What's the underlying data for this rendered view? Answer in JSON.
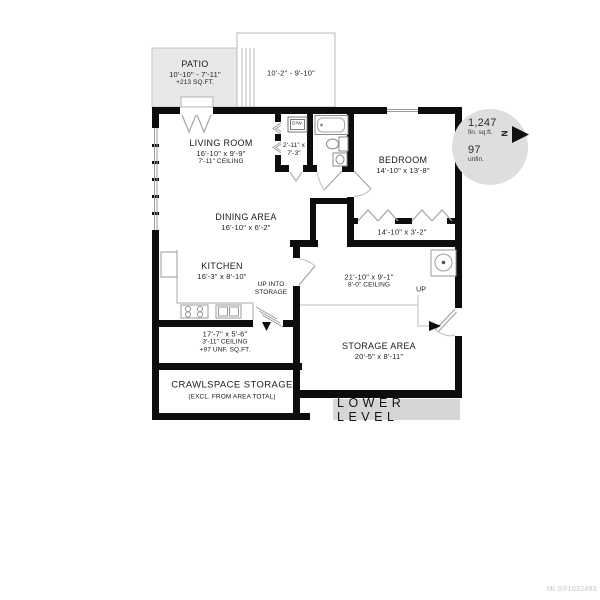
{
  "plan": {
    "patio": {
      "name": "PATIO",
      "dims": "10'-10\" - 7'-11\"",
      "area": "+213 SQ.FT."
    },
    "deck": {
      "dims": "10'-2\" - 9'-10\""
    },
    "living_room": {
      "name": "LIVING ROOM",
      "dims": "16'-10\" x 9'-9\"",
      "ceiling": "7'-11\" CEILING"
    },
    "laundry_closet": {
      "dims_line1": "2'-11\" x",
      "dims_line2": "7'-3\"",
      "appliance_label": "D/W"
    },
    "bedroom": {
      "name": "BEDROOM",
      "dims": "14'-10\" x 13'-8\""
    },
    "bedroom_closet": {
      "dims": "14'-10\" x 3'-2\""
    },
    "dining_area": {
      "name": "DINING AREA",
      "dims": "16'-10\" x 6'-2\""
    },
    "kitchen": {
      "name": "KITCHEN",
      "dims": "16'-3\" x 8'-10\""
    },
    "stair_note": {
      "line1": "UP INTO",
      "line2": "STORAGE"
    },
    "hall": {
      "dims": "21'-10\" x 9'-1\"",
      "ceiling": "8'-0\" CEILING",
      "up_label": "UP"
    },
    "under_stair_storage": {
      "dims": "17'-7\" x 5'-6\"",
      "ceiling": "3'-11\" CEILING",
      "area": "+97 UNF. SQ.FT."
    },
    "crawlspace": {
      "name": "CRAWLSPACE STORAGE",
      "note": "(EXCL. FROM AREA TOTAL)"
    },
    "storage_area": {
      "name": "STORAGE AREA",
      "dims": "20'-5\" x 8'-11\""
    }
  },
  "compass": {
    "finished_value": "1,247",
    "finished_label": "fin. sq.ft.",
    "unfinished_value": "97",
    "unfinished_label": "unfin.",
    "north_label": "N"
  },
  "footer": {
    "level_label": "LOWER LEVEL",
    "mls_number": "MLS®1032493"
  },
  "icons": {
    "north_arrow": "north-arrow-icon",
    "stairs_down": "stairs-icon",
    "stove": "stove-icon",
    "kitchen_sink": "sink-icon",
    "refrigerator": "refrigerator-icon",
    "bathtub": "bathtub-icon",
    "toilet": "toilet-icon",
    "bath_sink": "vanity-sink-icon",
    "washer_dryer": "washer-dryer-icon",
    "water_heater": "water-heater-icon"
  },
  "colors": {
    "wall": "#0d0d0d",
    "patio_fill": "#e8e8e8",
    "compass_fill": "#dedede",
    "level_bar_fill": "#d6d6d6",
    "fixture_line": "#999999",
    "mls_text": "#c6c6c6"
  }
}
